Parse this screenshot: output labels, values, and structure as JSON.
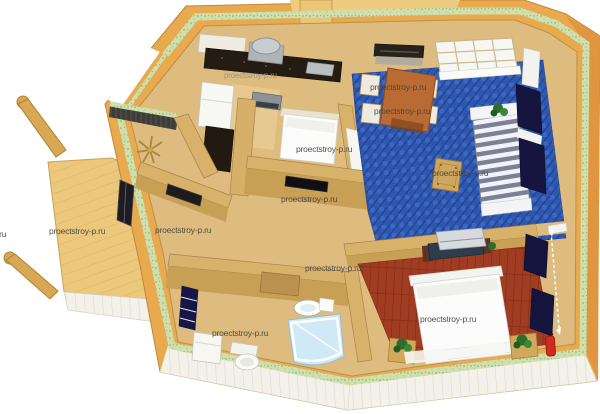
{
  "scene": {
    "title": "3D house floor plan render",
    "background_color": "#ffffff",
    "watermark": {
      "text": "proectstroy-p.ru",
      "count": 12,
      "color": "#45453d",
      "color_on_dark": "#96948a"
    },
    "palette": {
      "exterior_wall_wood": "#e9a94f",
      "exterior_wall_side": "#e09540",
      "insulation_stripe_green": "#cfe0ae",
      "interior_floor_wood": "#debb7e",
      "porch_deck": "#ecc87c",
      "living_carpet_blue": "#2e58ae",
      "bedroom_floor_brick": "#a03c22",
      "siding_white": "#f3f1ea",
      "curtain_navy": "#15153f",
      "sofa_stripe_gray": "#7c8199",
      "table_wood": "#b96b33",
      "bed_white": "#fcfcfc",
      "plant_green": "#2c6e2c",
      "extinguisher_red": "#cf2b20",
      "kitchen_counter_dark": "#241b12"
    },
    "rooms": [
      {
        "name": "kitchen"
      },
      {
        "name": "living-dining-room"
      },
      {
        "name": "entry-hall"
      },
      {
        "name": "alcove-bedroom"
      },
      {
        "name": "bathroom"
      },
      {
        "name": "main-bedroom"
      },
      {
        "name": "porch-deck"
      }
    ],
    "furniture": [
      "kitchen-counter",
      "cooker-hood",
      "fridge",
      "oven",
      "dining-table",
      "chairs-x4",
      "striped-sofa",
      "side-stool",
      "skylight-window",
      "navy-curtains",
      "double-bed",
      "alcove-bed",
      "tv-dresser",
      "nightstands",
      "plants",
      "washing-machine",
      "toilet",
      "sink",
      "shower-cabin",
      "fire-extinguisher",
      "dimension-line",
      "star-coat-rack"
    ]
  }
}
